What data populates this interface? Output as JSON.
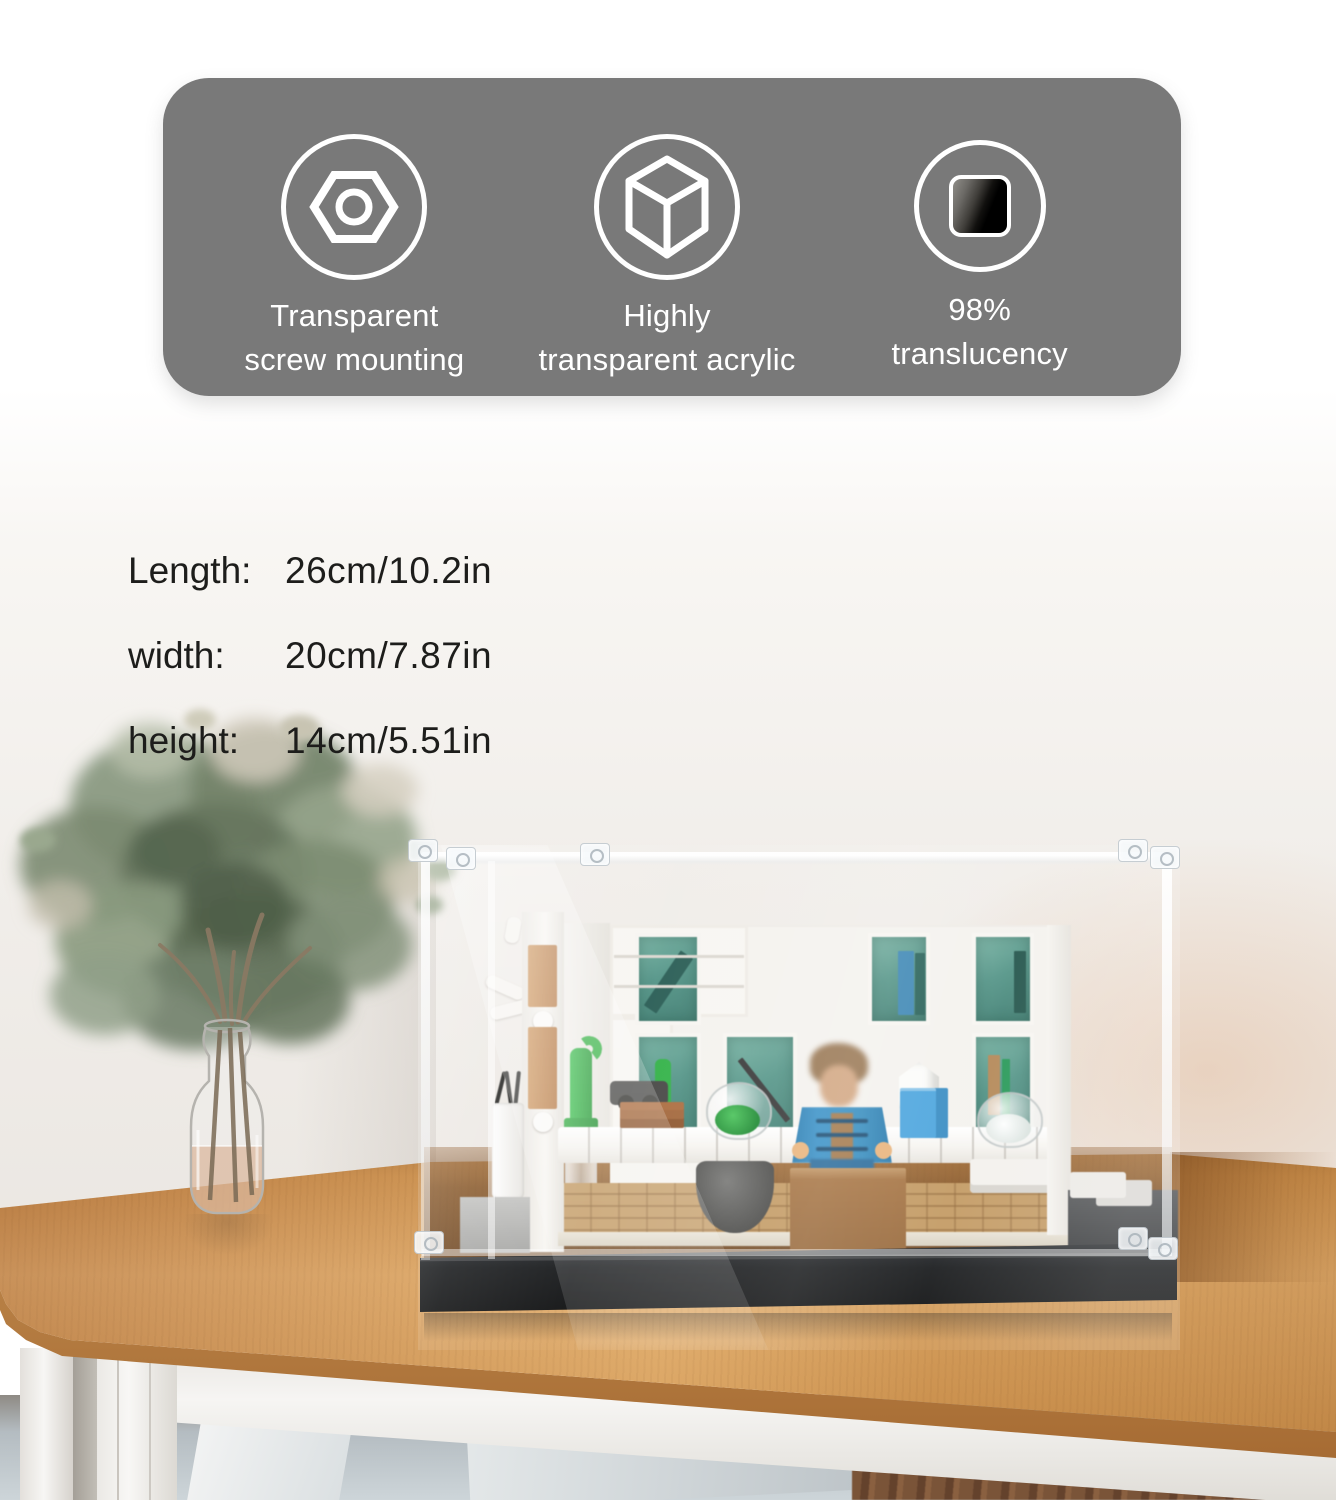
{
  "banner": {
    "bg_color": "#797979",
    "features": [
      {
        "icon": "hex-nut-icon",
        "label": "Transparent\nscrew mounting"
      },
      {
        "icon": "cube-icon",
        "label": "Highly\ntransparent acrylic"
      },
      {
        "icon": "translucency-swatch-icon",
        "label": "98%\ntranslucency"
      }
    ]
  },
  "dimensions": {
    "rows": [
      {
        "label": "Length:",
        "value": "26cm/10.2in"
      },
      {
        "label": "width:",
        "value": "20cm/7.87in"
      },
      {
        "label": "height:",
        "value": "14cm/5.51in"
      }
    ]
  },
  "photo": {
    "colors": {
      "accent_green": "#3cb44a",
      "minifig_blue": "#3a8fc0",
      "cabinet_teal": "#579a8c",
      "table_wood": "#d49a5c",
      "case_base_black": "#1d1f21",
      "wall": "#efedea"
    }
  }
}
